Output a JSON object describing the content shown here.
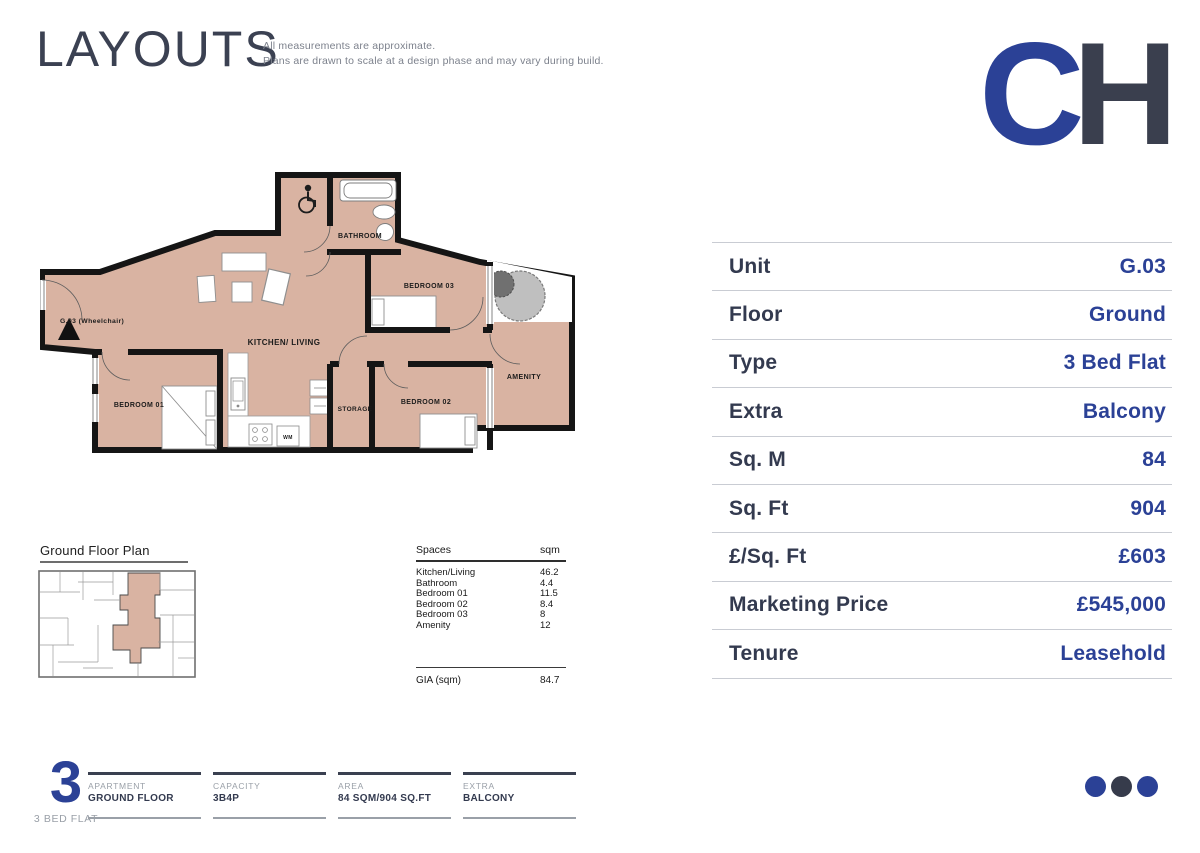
{
  "header": {
    "title": "LAYOUTS",
    "disclaimer_line1": "All measurements are approximate.",
    "disclaimer_line2": "Plans are drawn to scale at a design phase and may vary during build.",
    "logo": {
      "c": "C",
      "h": "H"
    }
  },
  "plan": {
    "rooms": {
      "kitchen_living": "KITCHEN/ LIVING",
      "bathroom": "BATHROOM",
      "bedroom01": "BEDROOM 01",
      "bedroom02": "BEDROOM 02",
      "bedroom03": "BEDROOM 03",
      "storage": "STORAGE",
      "amenity": "AMENITY",
      "unit_label": "G.03 (Wheelchair)",
      "wm": "WM"
    },
    "colors": {
      "room_fill": "#d9b3a2",
      "wall": "#151515"
    }
  },
  "ground_floor_plan": {
    "title": "Ground Floor Plan"
  },
  "spaces_table": {
    "col1": "Spaces",
    "col2": "sqm",
    "rows": [
      [
        "Kitchen/Living",
        "46.2"
      ],
      [
        "Bathroom",
        "4.4"
      ],
      [
        "Bedroom 01",
        "11.5"
      ],
      [
        "Bedroom 02",
        "8.4"
      ],
      [
        "Bedroom 03",
        "8"
      ],
      [
        "Amenity",
        "12"
      ]
    ],
    "total_label": "GIA (sqm)",
    "total_value": "84.7"
  },
  "info_table": {
    "rows": [
      {
        "label": "Unit",
        "value": "G.03"
      },
      {
        "label": "Floor",
        "value": "Ground"
      },
      {
        "label": "Type",
        "value": "3 Bed Flat"
      },
      {
        "label": "Extra",
        "value": "Balcony"
      },
      {
        "label": "Sq. M",
        "value": "84"
      },
      {
        "label": "Sq. Ft",
        "value": "904"
      },
      {
        "label": "£/Sq. Ft",
        "value": "£603"
      },
      {
        "label": "Marketing Price",
        "value": "£545,000"
      },
      {
        "label": "Tenure",
        "value": "Leasehold"
      }
    ]
  },
  "footer": {
    "big_number": "3",
    "subtitle": "3 BED FLAT",
    "columns": [
      {
        "label": "APARTMENT",
        "value": "GROUND FLOOR"
      },
      {
        "label": "CAPACITY",
        "value": "3B4P"
      },
      {
        "label": "AREA",
        "value": "84 SQM/904 SQ.FT"
      },
      {
        "label": "EXTRA",
        "value": "BALCONY"
      }
    ]
  },
  "colors": {
    "accent_blue": "#2b4196",
    "navy": "#333a4f",
    "gray_text": "#9aa0a8"
  }
}
